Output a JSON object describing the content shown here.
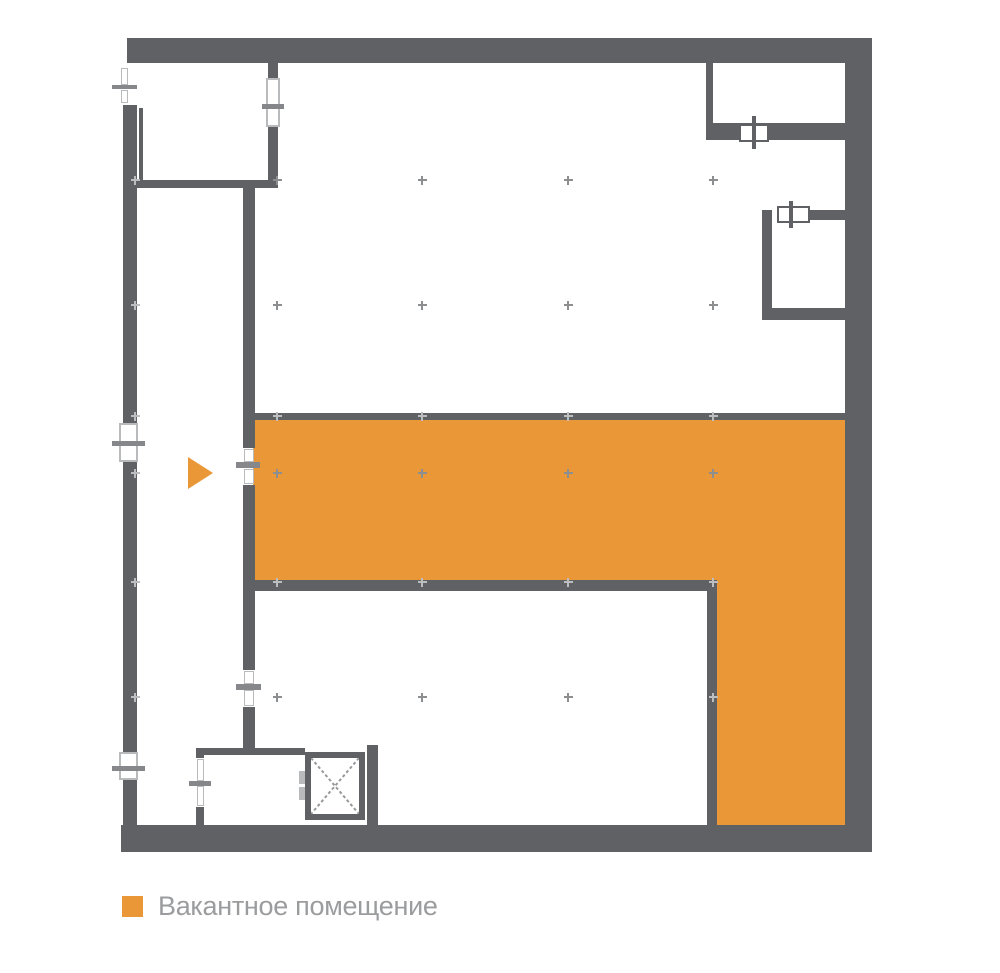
{
  "colors": {
    "background": "#ffffff",
    "wall": "#5F6164",
    "accent": "#EA9737",
    "symbol_light": "#b9babc",
    "tick": "#85878a",
    "marker_dark": "#8d8e90",
    "marker_light": "#bcbdbf",
    "x_line": "#97989a",
    "legend_text": "#9b9c9e"
  },
  "legend": {
    "items": [
      {
        "label": "Вакантное помещение",
        "swatch_color": "#EA9737"
      }
    ]
  },
  "plan": {
    "grid_markers": [
      {
        "x": 135,
        "y": 180,
        "shade": "light"
      },
      {
        "x": 135,
        "y": 305,
        "shade": "light"
      },
      {
        "x": 135,
        "y": 416,
        "shade": "light"
      },
      {
        "x": 135,
        "y": 473,
        "shade": "light"
      },
      {
        "x": 135,
        "y": 582,
        "shade": "light"
      },
      {
        "x": 135,
        "y": 697,
        "shade": "light"
      },
      {
        "x": 277,
        "y": 180,
        "shade": "dark"
      },
      {
        "x": 277,
        "y": 305,
        "shade": "dark"
      },
      {
        "x": 277,
        "y": 416,
        "shade": "light"
      },
      {
        "x": 277,
        "y": 473,
        "shade": "dark"
      },
      {
        "x": 277,
        "y": 582,
        "shade": "light"
      },
      {
        "x": 277,
        "y": 697,
        "shade": "dark"
      },
      {
        "x": 422,
        "y": 180,
        "shade": "dark"
      },
      {
        "x": 422,
        "y": 305,
        "shade": "dark"
      },
      {
        "x": 422,
        "y": 416,
        "shade": "light"
      },
      {
        "x": 422,
        "y": 473,
        "shade": "dark"
      },
      {
        "x": 422,
        "y": 582,
        "shade": "light"
      },
      {
        "x": 422,
        "y": 697,
        "shade": "dark"
      },
      {
        "x": 568,
        "y": 180,
        "shade": "dark"
      },
      {
        "x": 568,
        "y": 305,
        "shade": "dark"
      },
      {
        "x": 568,
        "y": 416,
        "shade": "light"
      },
      {
        "x": 568,
        "y": 473,
        "shade": "dark"
      },
      {
        "x": 568,
        "y": 582,
        "shade": "light"
      },
      {
        "x": 568,
        "y": 697,
        "shade": "dark"
      },
      {
        "x": 713,
        "y": 180,
        "shade": "dark"
      },
      {
        "x": 713,
        "y": 305,
        "shade": "dark"
      },
      {
        "x": 713,
        "y": 416,
        "shade": "light"
      },
      {
        "x": 713,
        "y": 473,
        "shade": "dark"
      },
      {
        "x": 713,
        "y": 582,
        "shade": "light"
      },
      {
        "x": 713,
        "y": 697,
        "shade": "light"
      }
    ]
  }
}
